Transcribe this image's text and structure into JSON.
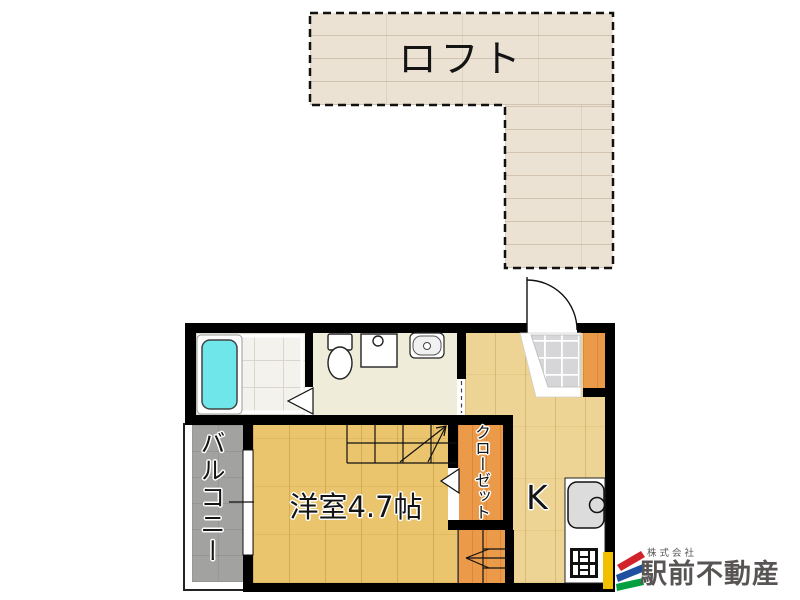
{
  "rooms": {
    "loft": "ロフト",
    "balcony": "バルコニー",
    "western_room": "洋室4.7帖",
    "closet": "クローゼット",
    "kitchen": "K"
  },
  "branding": {
    "company_prefix": "株式会社",
    "company_name": "駅前不動産"
  },
  "fixtures": [
    "bathtub-icon",
    "toilet-icon",
    "washing-machine-pan-icon",
    "vanity-sink-icon",
    "entry-door-swing-icon",
    "genkan-tile",
    "sliding-window-icon",
    "folding-door-bathroom-icon",
    "folding-door-closet-icon",
    "staircase-up-icon",
    "staircase-entry-icon",
    "kitchen-sink-icon",
    "gas-stove-icon"
  ],
  "colors": {
    "wall": "#000000",
    "loft_floor": "#ece2d4",
    "room_floor": "#eac56d",
    "kitchen_floor": "#edd494",
    "accent_orange": "#eb9a49",
    "washroom_floor": "#efecda",
    "bathroom_tile": "#f4f2ed",
    "genkan_tile": "#d6d6d8",
    "balcony_concrete": "#a2a2a0",
    "bathtub_cyan": "#6fe6e9",
    "logo_yellow": "#f3c000",
    "logo_red": "#d2232a",
    "logo_blue": "#1f4fa0",
    "logo_green": "#00a040",
    "logo_text": "#595555"
  }
}
